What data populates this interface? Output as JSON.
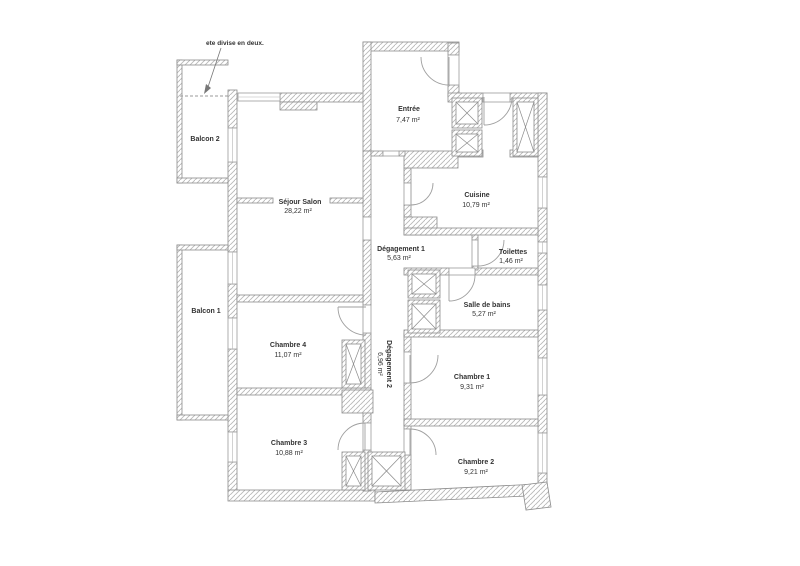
{
  "annotation": {
    "text": "ete divise en deux."
  },
  "rooms": {
    "balcon2": {
      "name": "Balcon 2"
    },
    "balcon1": {
      "name": "Balcon 1"
    },
    "entree": {
      "name": "Entrée",
      "area": "7,47 m²"
    },
    "sejour": {
      "name": "Séjour  Salon",
      "area": "28,22 m²"
    },
    "cuisine": {
      "name": "Cuisine",
      "area": "10,79 m²"
    },
    "degagement1": {
      "name": "Dégagement 1",
      "area": "5,63 m²"
    },
    "toilettes": {
      "name": "Toilettes",
      "area": "1,46 m²"
    },
    "salle_de_bains": {
      "name": "Salle de bains",
      "area": "5,27 m²"
    },
    "chambre4": {
      "name": "Chambre 4",
      "area": "11,07 m²"
    },
    "degagement2": {
      "name": "Dégagement 2",
      "area": "6,96 m²"
    },
    "chambre1": {
      "name": "Chambre 1",
      "area": "9,31 m²"
    },
    "chambre3": {
      "name": "Chambre 3",
      "area": "10,88 m²"
    },
    "chambre2": {
      "name": "Chambre 2",
      "area": "9,21 m²"
    }
  },
  "colors": {
    "wall_hatch": "#b9b9b9",
    "wall_stroke": "#8c8c8c",
    "text": "#333333",
    "background": "#ffffff"
  }
}
